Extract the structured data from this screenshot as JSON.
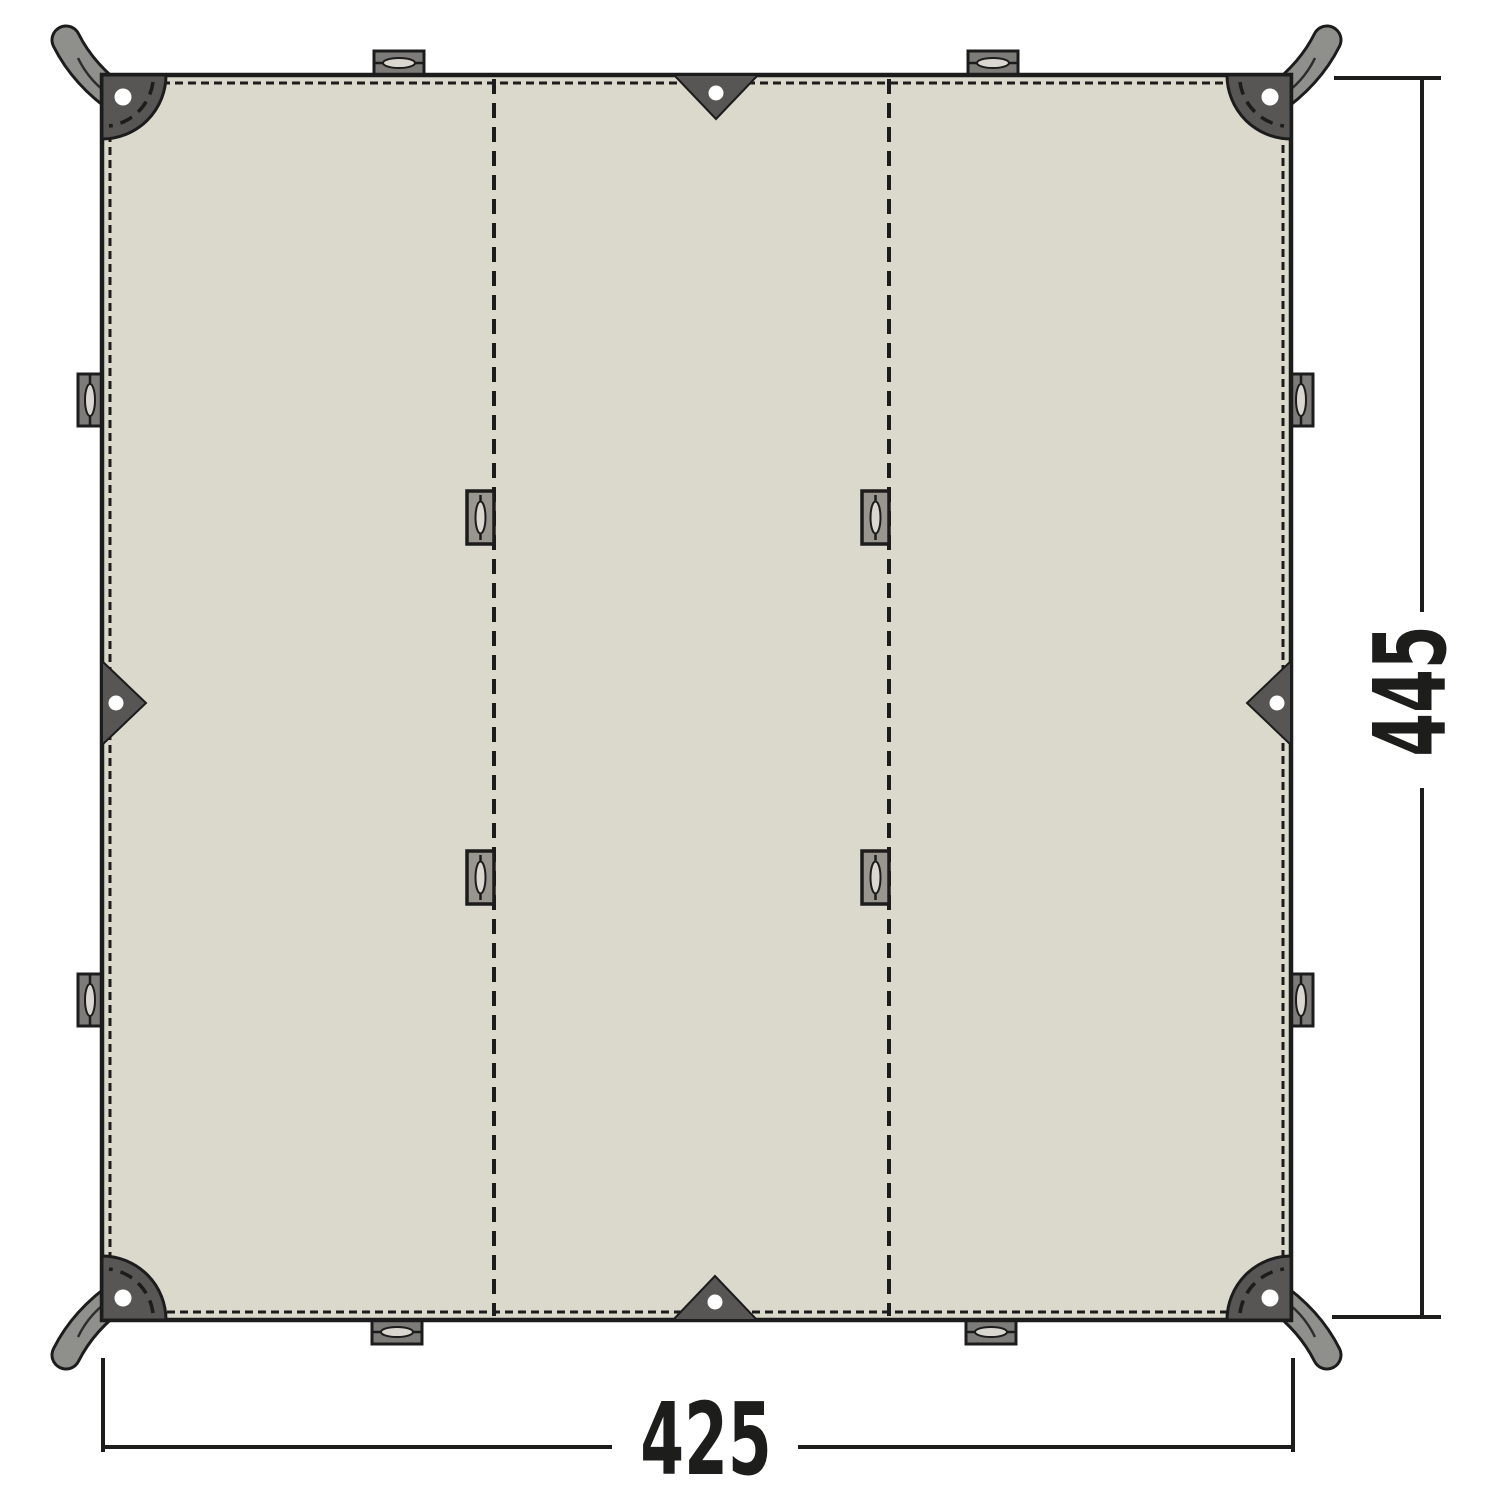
{
  "diagram": {
    "bottom_dimension": "425",
    "side_dimension": "445"
  },
  "colors": {
    "background": "#ffffff",
    "tarp": "#dbd8cc",
    "outline": "#1c1c1c",
    "patch": "#575654",
    "strap": "#8f8f8b",
    "tab": "#7d7c78",
    "loop": "#98968f",
    "slot": "#d9d7d0",
    "grommet": "#ffffff",
    "dim": "#1d1d1b"
  }
}
